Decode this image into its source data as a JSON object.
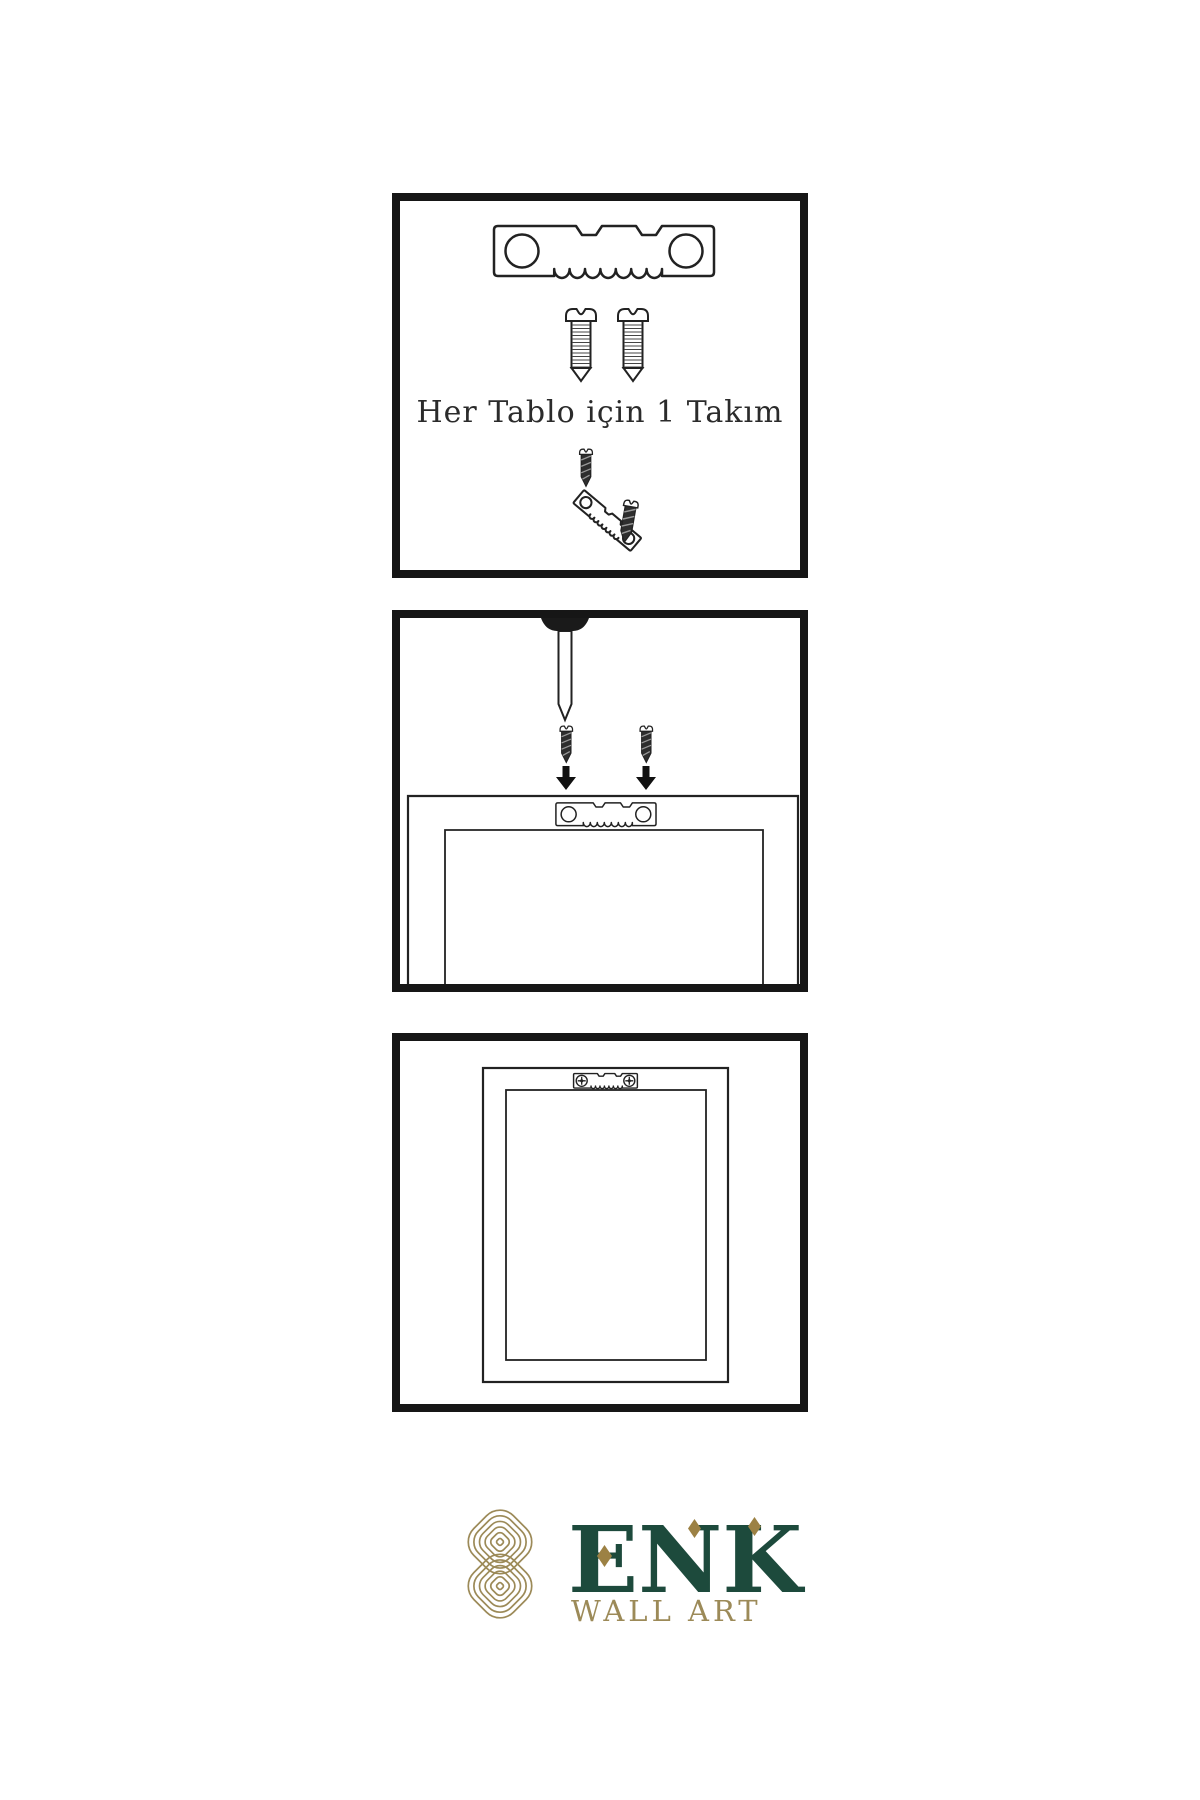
{
  "page": {
    "background": "#ffffff",
    "ink": "#1f1f1f"
  },
  "instructions": {
    "panel1": {
      "caption": "Her Tablo için 1 Takım"
    }
  },
  "logo": {
    "brand": "ENK",
    "subtitle": "WALL ART",
    "colors": {
      "green": "#1d4a3c",
      "gold": "#9c8a58"
    }
  }
}
